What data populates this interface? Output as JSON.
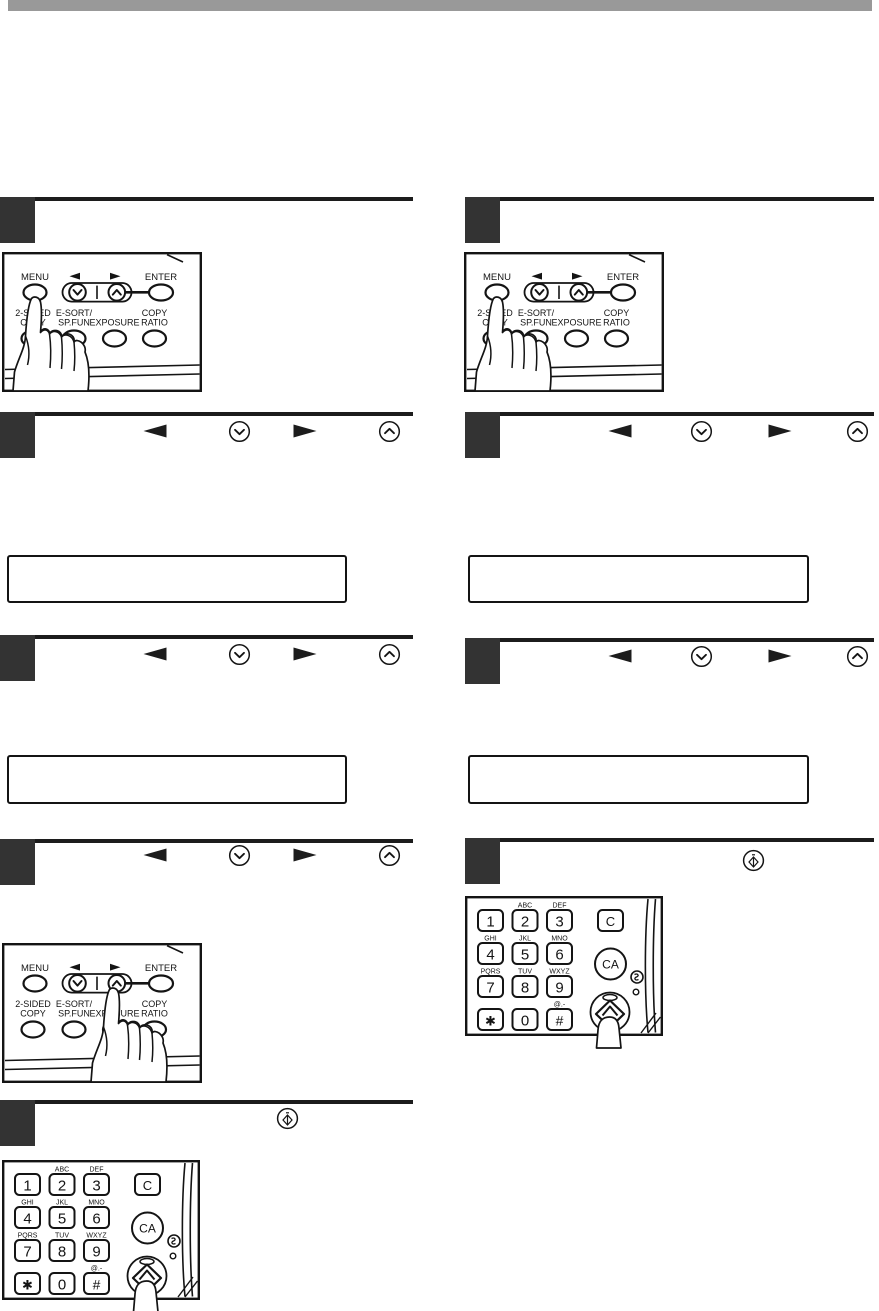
{
  "page": {
    "background": "#ffffff",
    "top_bar_color": "#999999",
    "ink_color": "#141414",
    "step_box_color": "#333333",
    "description": "Scanned copier manual page: two columns of numbered steps with control-panel and keypad illustrations and empty LCD display boxes"
  },
  "control_panel": {
    "menu": "MENU",
    "enter": "ENTER",
    "left_arrow_glyph": "◄",
    "right_arrow_glyph": "►",
    "two_sided_copy_line1": "2-SIDED",
    "two_sided_copy_line2": "COPY",
    "e_sort_line1": "E-SORT/",
    "e_sort_line2": "SP.FUN",
    "exposure": "EXPOSURE",
    "copy_ratio_line1": "COPY",
    "copy_ratio_line2": "RATIO"
  },
  "keypad": {
    "digit_1": "1",
    "digit_2": "2",
    "digit_3": "3",
    "digit_4": "4",
    "digit_5": "5",
    "digit_6": "6",
    "digit_7": "7",
    "digit_8": "8",
    "digit_9": "9",
    "digit_0": "0",
    "star": "✱",
    "hash": "#",
    "clear": "C",
    "clear_all": "CA",
    "letters_2": "ABC",
    "letters_3": "DEF",
    "letters_4": "GHI",
    "letters_5": "JKL",
    "letters_6": "MNO",
    "letters_7": "PQRS",
    "letters_8": "TUV",
    "letters_9": "WXYZ",
    "letters_hash": "@.-"
  },
  "left_column": {
    "steps": [
      {
        "step": 1,
        "content": "control-panel-illustration-hand-pressing-menu"
      },
      {
        "step": 2,
        "heading_icons": [
          "left-arrow-key",
          "down-arrow-key",
          "right-arrow-key",
          "up-arrow-key"
        ],
        "display_text": ""
      },
      {
        "step": 3,
        "heading_icons": [
          "left-arrow-key",
          "down-arrow-key",
          "right-arrow-key",
          "up-arrow-key"
        ],
        "display_text": ""
      },
      {
        "step": 4,
        "heading_icons": [
          "left-arrow-key",
          "down-arrow-key",
          "right-arrow-key",
          "up-arrow-key"
        ],
        "content": "control-panel-illustration-hand-pressing-right-key"
      },
      {
        "step": 5,
        "heading_icons": [
          "start-key"
        ],
        "content": "numeric-keypad-illustration-hand-pressing-start"
      }
    ]
  },
  "right_column": {
    "steps": [
      {
        "step": 1,
        "content": "control-panel-illustration-hand-pressing-menu"
      },
      {
        "step": 2,
        "heading_icons": [
          "left-arrow-key",
          "down-arrow-key",
          "right-arrow-key",
          "up-arrow-key"
        ],
        "display_text": ""
      },
      {
        "step": 3,
        "heading_icons": [
          "left-arrow-key",
          "down-arrow-key",
          "right-arrow-key",
          "up-arrow-key"
        ],
        "display_text": ""
      },
      {
        "step": 4,
        "heading_icons": [
          "start-key"
        ],
        "content": "numeric-keypad-illustration-hand-pressing-start"
      }
    ]
  }
}
